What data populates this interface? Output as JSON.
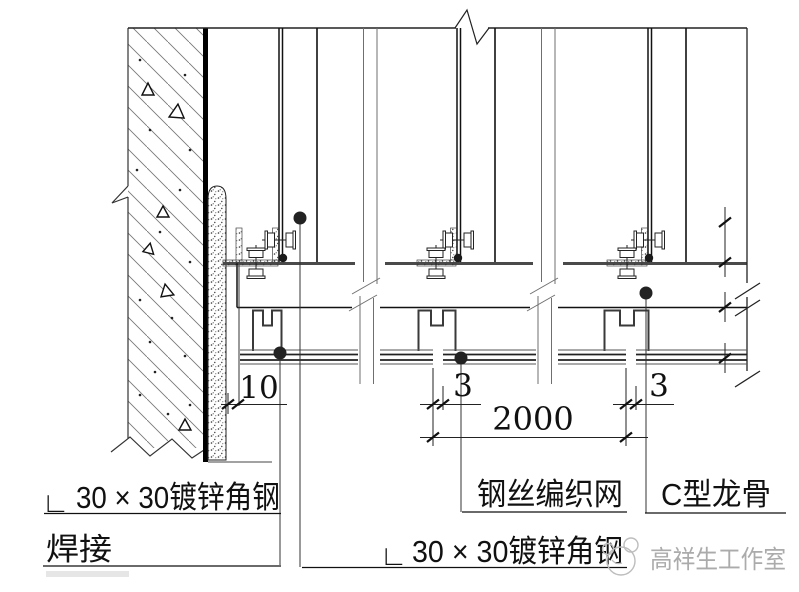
{
  "drawing": {
    "dimensions": {
      "wall_gap": "10",
      "mesh_gap_left": "3",
      "span": "2000",
      "mesh_gap_right": "3"
    },
    "labels": {
      "angle_symbol": "∟",
      "angle_steel_left": "30 × 30镀锌角钢",
      "weld": "焊接",
      "wire_mesh": "钢丝编织网",
      "c_keel": "C型龙骨",
      "angle_steel_bottom": "30 × 30镀锌角钢"
    },
    "watermark": {
      "studio": "高祥生工作室"
    },
    "colors": {
      "line": "#1a1a1a",
      "beam_edge": "#4a4a4a",
      "watermark": "#ababab"
    }
  }
}
